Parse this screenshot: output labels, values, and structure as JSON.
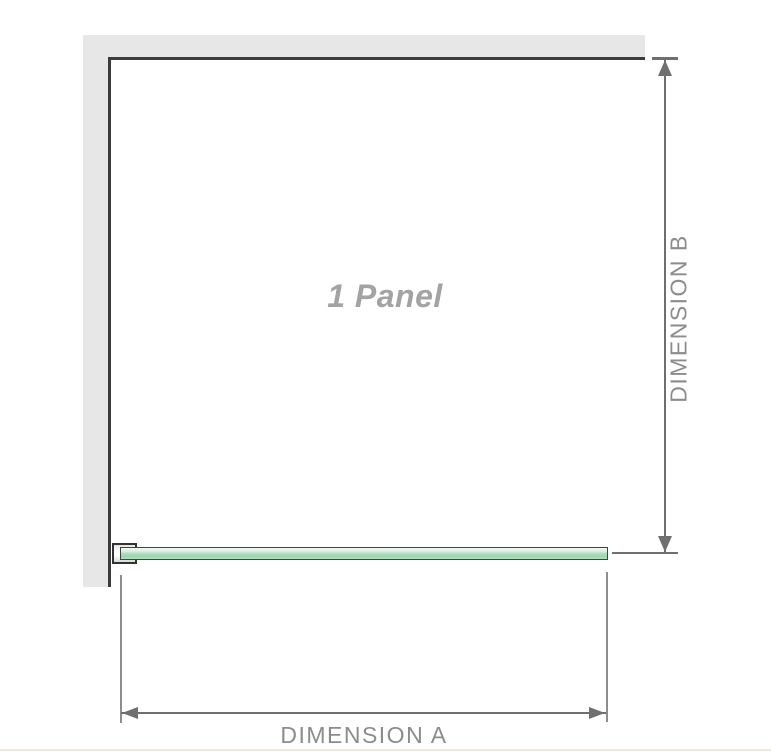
{
  "diagram": {
    "panel_label": "1 Panel",
    "dimension_a": {
      "label": "DIMENSION A"
    },
    "dimension_b": {
      "label": "DIMENSION B"
    },
    "colors": {
      "wall_fill": "#e7e7e7",
      "wall_edge": "#3b3b3b",
      "dimension_line": "#6f6f6f",
      "extension_line": "#8d8d8d",
      "dimension_label_text": "#8c8c8c",
      "panel_label_text": "#a3a3a3",
      "glass_fill": "#a9dcba",
      "glass_border": "#39483e",
      "bracket_border": "#333333",
      "bottom_rule": "#ece8e0"
    }
  }
}
